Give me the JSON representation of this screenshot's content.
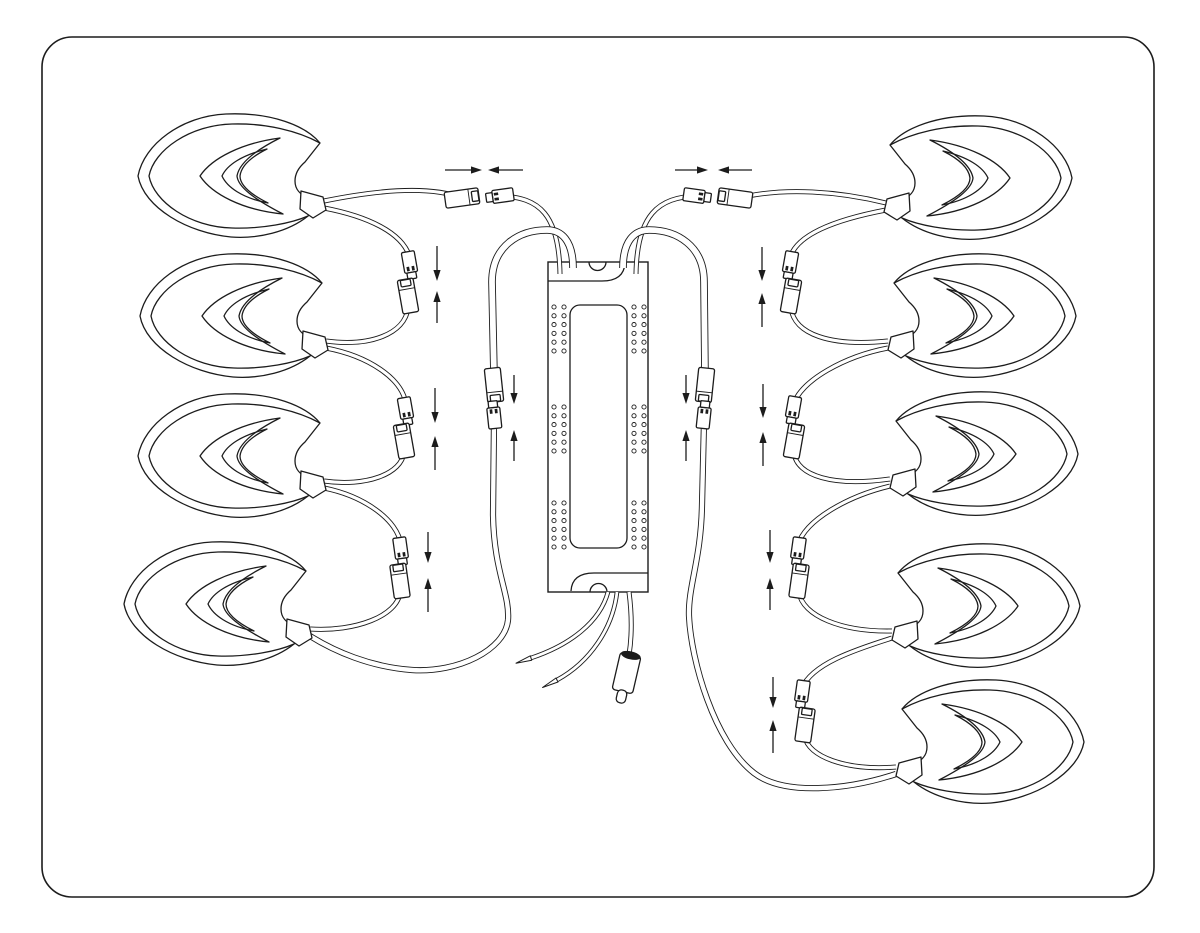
{
  "meta": {
    "description": "wiring installation diagram: nine leaf-shaped LED modules daisy-chained to a central LED driver",
    "visible_text": "none"
  },
  "canvas": {
    "width": 1200,
    "height": 933,
    "background": "#ffffff",
    "line_color": "#1c1c1c"
  },
  "border": {
    "x": 42,
    "y": 37,
    "width": 1112,
    "height": 860,
    "radius": 30,
    "stroke_width": 1.6
  },
  "driver": {
    "box": {
      "x": 548,
      "y": 262,
      "width": 100,
      "height": 330
    },
    "label_panel": {
      "x": 570,
      "y": 305,
      "width": 57,
      "height": 243,
      "radius": 10
    },
    "top_flange_line": "M 548,281 L 602,281 Q 624,281 625,263",
    "top_notch": "M 589,262 A 8.5 8.5 0 0 0 606,262",
    "bottom_flange_line": "M 648,573 L 594,573 Q 572,573 571,591",
    "bottom_notch": "M 590,592 A 8.5 8.5 0 0 1 607,592",
    "holes": {
      "left_cols": [
        554,
        564
      ],
      "right_cols": [
        634,
        644
      ],
      "group_tops": [
        307,
        407,
        503
      ],
      "rows": 6,
      "row_gap": 8.8,
      "radius": 2.1
    }
  },
  "leaf_modules": [
    {
      "id": "left-1",
      "side": "left",
      "x": 136,
      "y": 110
    },
    {
      "id": "left-2",
      "side": "left",
      "x": 138,
      "y": 250
    },
    {
      "id": "left-3",
      "side": "left",
      "x": 136,
      "y": 390
    },
    {
      "id": "left-4",
      "side": "left",
      "x": 122,
      "y": 538
    },
    {
      "id": "right-1",
      "side": "right",
      "x": 874,
      "y": 112
    },
    {
      "id": "right-2",
      "side": "right",
      "x": 878,
      "y": 250
    },
    {
      "id": "right-3",
      "side": "right",
      "x": 880,
      "y": 388
    },
    {
      "id": "right-4",
      "side": "right",
      "x": 882,
      "y": 540
    },
    {
      "id": "right-5",
      "side": "right",
      "x": 886,
      "y": 676
    }
  ],
  "cables": [
    {
      "id": "left-top-leaf-cable",
      "d": "M 324,201 C 368,192 426,184 462,198",
      "w": 5
    },
    {
      "id": "left-top-driver-cable",
      "d": "M 500,196 C 540,197 559,215 560,274",
      "w": 5
    },
    {
      "id": "left-return-loop-cable",
      "d": "M 573,268 C 573,240 561,230 547,230 C 519,230 492,246 492,282 L 494,376",
      "w": 7.6
    },
    {
      "id": "left-chain-cable-1a",
      "d": "M 324,208 C 366,216 403,232 410,258",
      "w": 5
    },
    {
      "id": "left-chain-cable-1b",
      "d": "M 408,308 C 405,334 370,347 326,341",
      "w": 5
    },
    {
      "id": "left-chain-cable-2a",
      "d": "M 326,348 C 368,356 402,378 406,404",
      "w": 5
    },
    {
      "id": "left-chain-cable-2b",
      "d": "M 404,452 C 402,474 366,487 324,481",
      "w": 5
    },
    {
      "id": "left-chain-cable-3a",
      "d": "M 324,488 C 364,496 398,520 401,545",
      "w": 5
    },
    {
      "id": "left-chain-cable-3b",
      "d": "M 400,592 C 398,616 355,632 310,629",
      "w": 5
    },
    {
      "id": "left-return-long-cable",
      "d": "M 494,422 L 493,515 C 494,572 510,594 508,620 C 505,650 458,673 412,670 C 370,667 334,651 310,636",
      "w": 6.2
    },
    {
      "id": "right-top-leaf-cable",
      "d": "M 886,203 C 842,192 784,186 735,199",
      "w": 5
    },
    {
      "id": "right-top-driver-cable",
      "d": "M 697,196 C 658,197 637,215 636,274",
      "w": 5
    },
    {
      "id": "right-return-loop-cable",
      "d": "M 623,268 C 623,240 635,230 649,230 C 677,230 704,246 704,282 L 705,376",
      "w": 7.6
    },
    {
      "id": "right-chain-cable-1a",
      "d": "M 886,210 C 844,218 797,232 790,258",
      "w": 5
    },
    {
      "id": "right-chain-cable-1b",
      "d": "M 791,308 C 794,334 830,347 888,341",
      "w": 5
    },
    {
      "id": "right-chain-cable-2a",
      "d": "M 888,348 C 846,356 800,380 793,406",
      "w": 5
    },
    {
      "id": "right-chain-cable-2b",
      "d": "M 794,453 C 797,476 833,487 890,479",
      "w": 5
    },
    {
      "id": "right-chain-cable-3a",
      "d": "M 890,486 C 848,496 805,520 798,545",
      "w": 5
    },
    {
      "id": "right-chain-cable-3b",
      "d": "M 799,592 C 802,616 842,632 892,631",
      "w": 5
    },
    {
      "id": "right-chain-cable-4a",
      "d": "M 892,638 C 854,650 812,664 802,688",
      "w": 5
    },
    {
      "id": "right-chain-cable-4b",
      "d": "M 805,737 C 808,756 845,771 896,767",
      "w": 5
    },
    {
      "id": "right-return-long-cable",
      "d": "M 704,422 L 702,505 C 701,560 688,586 689,616 C 691,660 714,742 754,773 C 784,796 848,790 896,774",
      "w": 6.2
    }
  ],
  "connectors": [
    {
      "id": "top-left-female",
      "type": "female",
      "cx": 462,
      "cy": 198,
      "angle": 82
    },
    {
      "id": "top-left-male",
      "type": "male",
      "cx": 500,
      "cy": 196,
      "angle": 82
    },
    {
      "id": "top-right-male",
      "type": "male",
      "cx": 697,
      "cy": 196,
      "angle": -82
    },
    {
      "id": "top-right-female",
      "type": "female",
      "cx": 735,
      "cy": 198,
      "angle": -82
    },
    {
      "id": "left-pair1-male",
      "type": "male",
      "cx": 410,
      "cy": 265,
      "angle": -10
    },
    {
      "id": "left-pair1-female",
      "type": "female",
      "cx": 408,
      "cy": 296,
      "angle": -10
    },
    {
      "id": "left-pair2-male",
      "type": "male",
      "cx": 406,
      "cy": 411,
      "angle": -10
    },
    {
      "id": "left-pair2-female",
      "type": "female",
      "cx": 404,
      "cy": 441,
      "angle": -10
    },
    {
      "id": "left-pair3-male",
      "type": "male",
      "cx": 401,
      "cy": 551,
      "angle": -8
    },
    {
      "id": "left-pair3-female",
      "type": "female",
      "cx": 400,
      "cy": 581,
      "angle": -8
    },
    {
      "id": "left-return-female",
      "type": "female",
      "cx": 494,
      "cy": 385,
      "angle": 174
    },
    {
      "id": "left-return-male",
      "type": "male",
      "cx": 494,
      "cy": 415,
      "angle": 174
    },
    {
      "id": "right-pair1-male",
      "type": "male",
      "cx": 790,
      "cy": 265,
      "angle": 10
    },
    {
      "id": "right-pair1-female",
      "type": "female",
      "cx": 791,
      "cy": 296,
      "angle": 10
    },
    {
      "id": "right-pair2-male",
      "type": "male",
      "cx": 793,
      "cy": 410,
      "angle": 10
    },
    {
      "id": "right-pair2-female",
      "type": "female",
      "cx": 794,
      "cy": 441,
      "angle": 10
    },
    {
      "id": "right-pair3-male",
      "type": "male",
      "cx": 798,
      "cy": 551,
      "angle": 8
    },
    {
      "id": "right-pair3-female",
      "type": "female",
      "cx": 799,
      "cy": 581,
      "angle": 8
    },
    {
      "id": "right-pair4-male",
      "type": "male",
      "cx": 802,
      "cy": 694,
      "angle": 8
    },
    {
      "id": "right-pair4-female",
      "type": "female",
      "cx": 805,
      "cy": 725,
      "angle": 8
    },
    {
      "id": "right-return-female",
      "type": "female",
      "cx": 705,
      "cy": 385,
      "angle": 186
    },
    {
      "id": "right-return-male",
      "type": "male",
      "cx": 704,
      "cy": 415,
      "angle": 186
    }
  ],
  "arrows": [
    {
      "id": "top-left-right-arrow",
      "orient": "h",
      "y": 170,
      "from": 445,
      "to": 482
    },
    {
      "id": "top-left-left-arrow",
      "orient": "h",
      "y": 170,
      "from": 523,
      "to": 488
    },
    {
      "id": "top-right-right-arrow",
      "orient": "h",
      "y": 170,
      "from": 675,
      "to": 708
    },
    {
      "id": "top-right-left-arrow",
      "orient": "h",
      "y": 170,
      "from": 752,
      "to": 718
    },
    {
      "id": "left-pair1-down-arrow",
      "orient": "v",
      "x": 437,
      "from": 246,
      "to": 281
    },
    {
      "id": "left-pair1-up-arrow",
      "orient": "v",
      "x": 437,
      "from": 323,
      "to": 291
    },
    {
      "id": "left-pair2-down-arrow",
      "orient": "v",
      "x": 435,
      "from": 388,
      "to": 423
    },
    {
      "id": "left-pair2-up-arrow",
      "orient": "v",
      "x": 435,
      "from": 470,
      "to": 436
    },
    {
      "id": "left-pair3-down-arrow",
      "orient": "v",
      "x": 428,
      "from": 532,
      "to": 563
    },
    {
      "id": "left-pair3-up-arrow",
      "orient": "v",
      "x": 428,
      "from": 612,
      "to": 578
    },
    {
      "id": "left-return-down-arrow",
      "orient": "v",
      "x": 514,
      "from": 375,
      "to": 404
    },
    {
      "id": "left-return-up-arrow",
      "orient": "v",
      "x": 514,
      "from": 461,
      "to": 430
    },
    {
      "id": "right-pair1-down-arrow",
      "orient": "v",
      "x": 762,
      "from": 247,
      "to": 281
    },
    {
      "id": "right-pair1-up-arrow",
      "orient": "v",
      "x": 762,
      "from": 327,
      "to": 293
    },
    {
      "id": "right-pair2-down-arrow",
      "orient": "v",
      "x": 763,
      "from": 384,
      "to": 418
    },
    {
      "id": "right-pair2-up-arrow",
      "orient": "v",
      "x": 763,
      "from": 466,
      "to": 432
    },
    {
      "id": "right-pair3-down-arrow",
      "orient": "v",
      "x": 770,
      "from": 530,
      "to": 563
    },
    {
      "id": "right-pair3-up-arrow",
      "orient": "v",
      "x": 770,
      "from": 610,
      "to": 578
    },
    {
      "id": "right-pair4-down-arrow",
      "orient": "v",
      "x": 773,
      "from": 677,
      "to": 708
    },
    {
      "id": "right-pair4-up-arrow",
      "orient": "v",
      "x": 773,
      "from": 753,
      "to": 720
    },
    {
      "id": "right-return-down-arrow",
      "orient": "v",
      "x": 686,
      "from": 375,
      "to": 404
    },
    {
      "id": "right-return-up-arrow",
      "orient": "v",
      "x": 686,
      "from": 461,
      "to": 430
    }
  ],
  "power_output": {
    "bare_wires": [
      {
        "id": "bare-wire-1",
        "d": "M 608,592 C 600,622 570,645 531,658",
        "w": 4.6,
        "tip": [
          [
            530.3,
            655.8
          ],
          [
            516,
            663.2
          ],
          [
            531.7,
            660.2
          ]
        ]
      },
      {
        "id": "bare-wire-2",
        "d": "M 617,592 C 613,628 590,662 557,680",
        "w": 4.6,
        "tip": [
          [
            556.0,
            678.0
          ],
          [
            542.5,
            687.5
          ],
          [
            558.0,
            682.0
          ]
        ]
      }
    ],
    "plug": {
      "cable_d": "M 629,592 C 632,615 632,636 629,655",
      "cable_w": 5,
      "body": {
        "cx": 626.5,
        "cy": 673,
        "w": 21,
        "h": 38,
        "angle": 13,
        "rx": 3
      },
      "band": {
        "cx": 630.8,
        "cy": 655.4,
        "rx": 10,
        "ry": 4,
        "angle": 13
      },
      "nub": {
        "cx": 621.5,
        "cy": 696.5,
        "w": 9.5,
        "h": 13,
        "angle": 13,
        "rx": 4
      }
    }
  }
}
